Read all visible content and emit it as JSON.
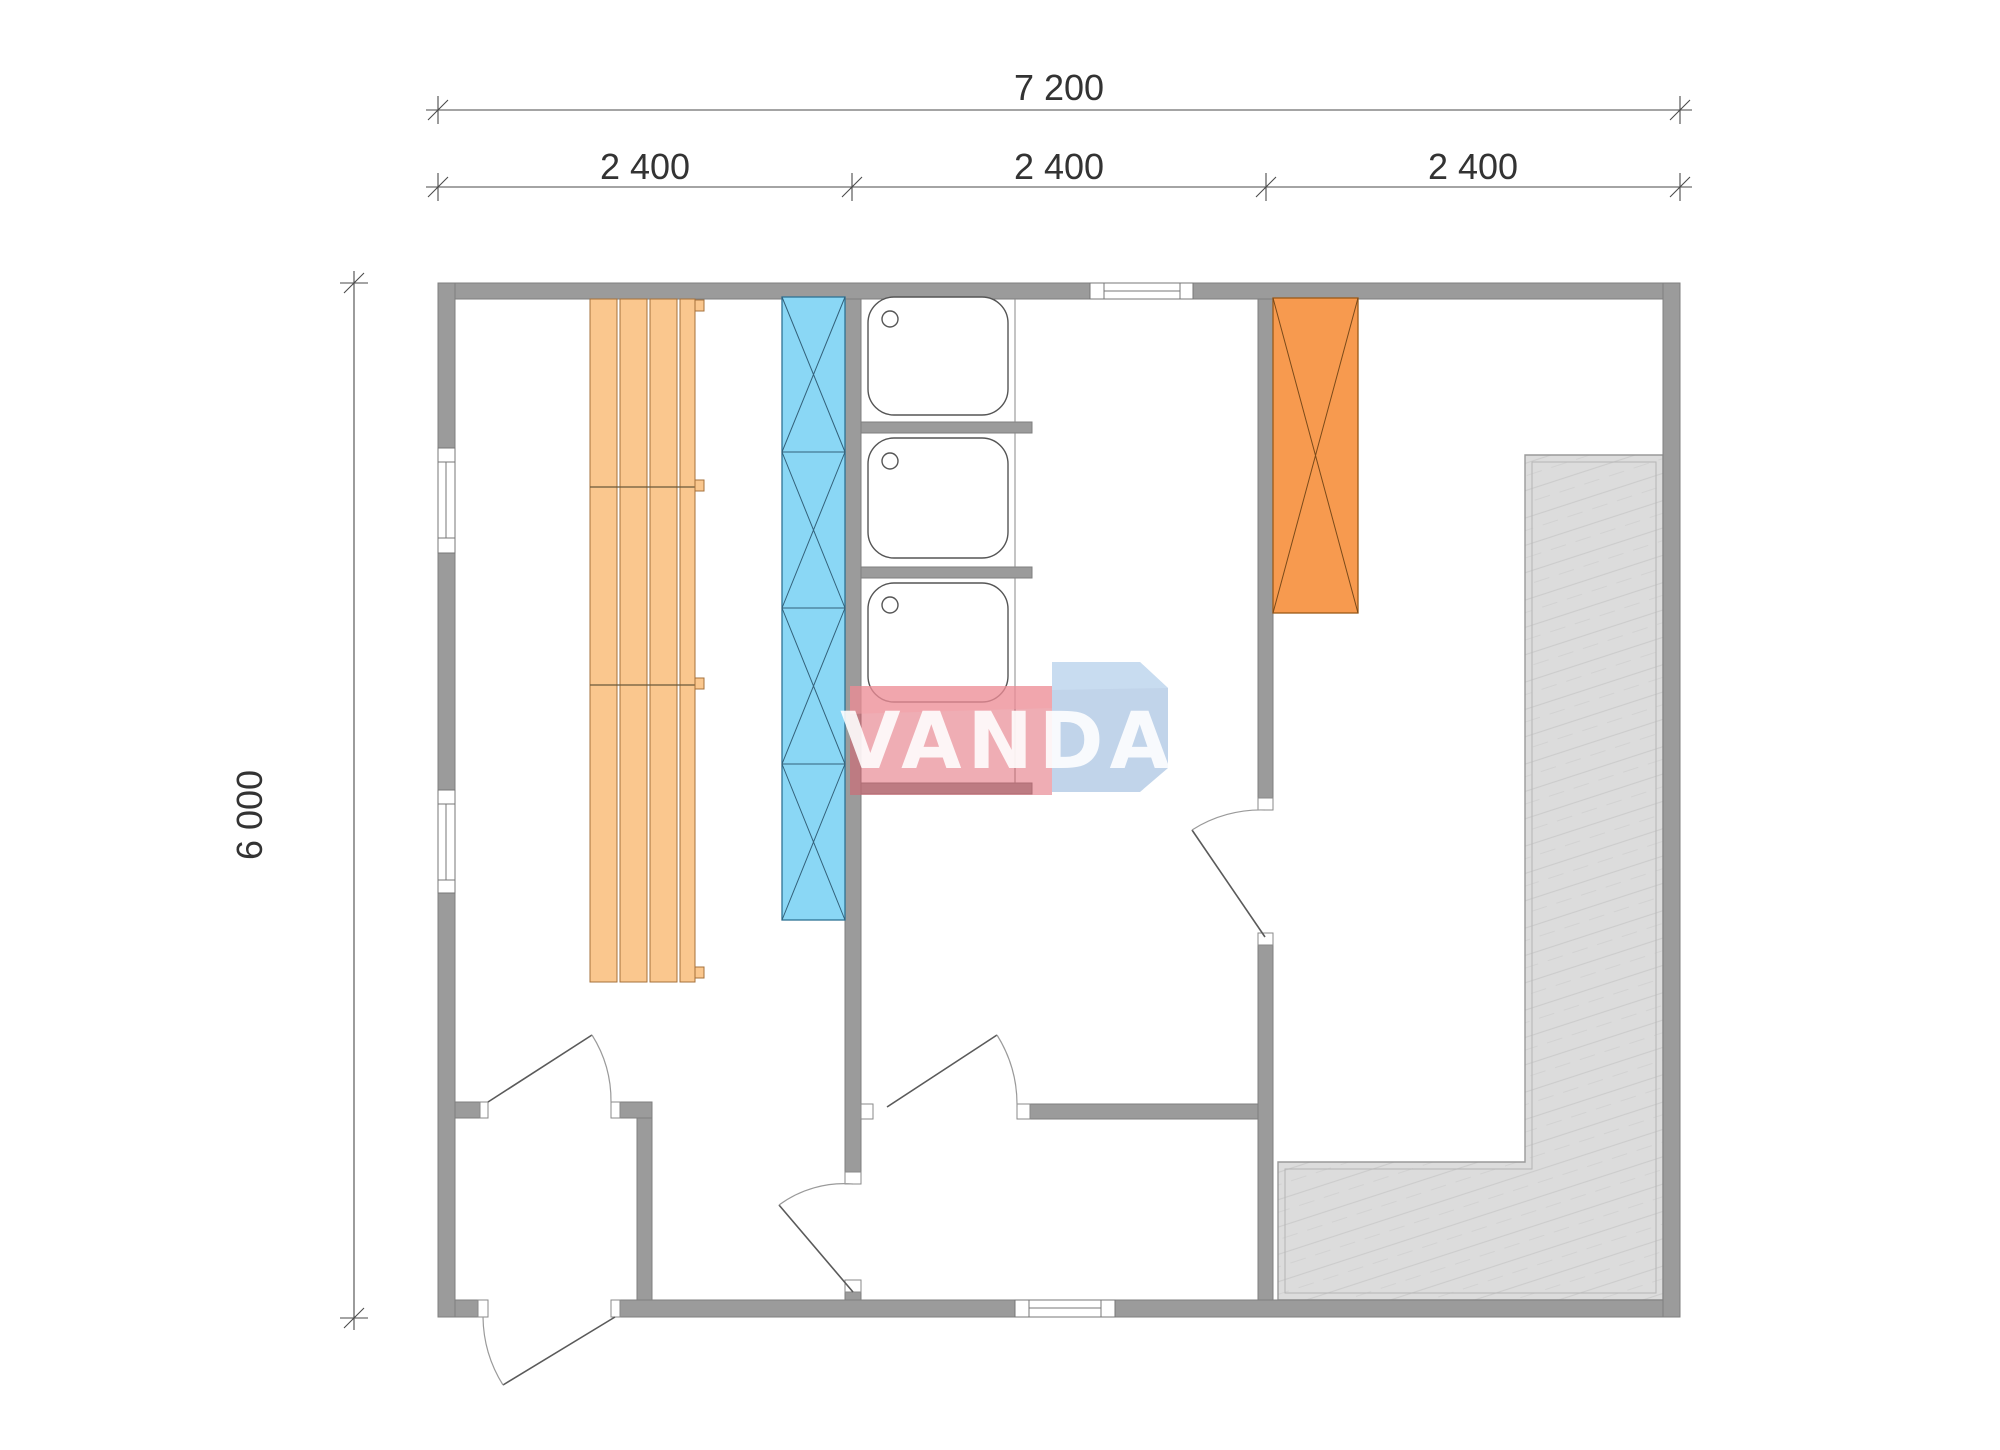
{
  "drawing": {
    "type": "floor-plan",
    "title": "sauna cabin floor plan"
  },
  "dimensions": {
    "total_width_label": "7 200",
    "segment_labels": [
      "2 400",
      "2 400",
      "2 400"
    ],
    "height_label": "6 000"
  },
  "watermark": {
    "text": "VANDA"
  },
  "colors": {
    "wall": "#9b9b9b",
    "wall-border": "#7f7f7f",
    "bench": "#FAC78E",
    "bench-border": "#A5703B",
    "panel-blue": "#8AD7F5",
    "panel-blue-border": "#2E7295",
    "heater-orange": "#F79A4F",
    "heater-border": "#9C5A17",
    "slab": "#DCDCDC",
    "slab-border": "#9a9a9a",
    "fixture-line": "#555555",
    "door-leaf": "#5a5a5a",
    "door-arc": "#9a9a9a",
    "dim-line": "#4a4a4a",
    "wm-red": "rgba(223,92,106,0.50)",
    "wm-red-light": "rgba(242,160,168,0.55)",
    "wm-blue": "rgba(132,170,214,0.50)",
    "wm-blue-light": "rgba(205,225,243,0.60)"
  }
}
